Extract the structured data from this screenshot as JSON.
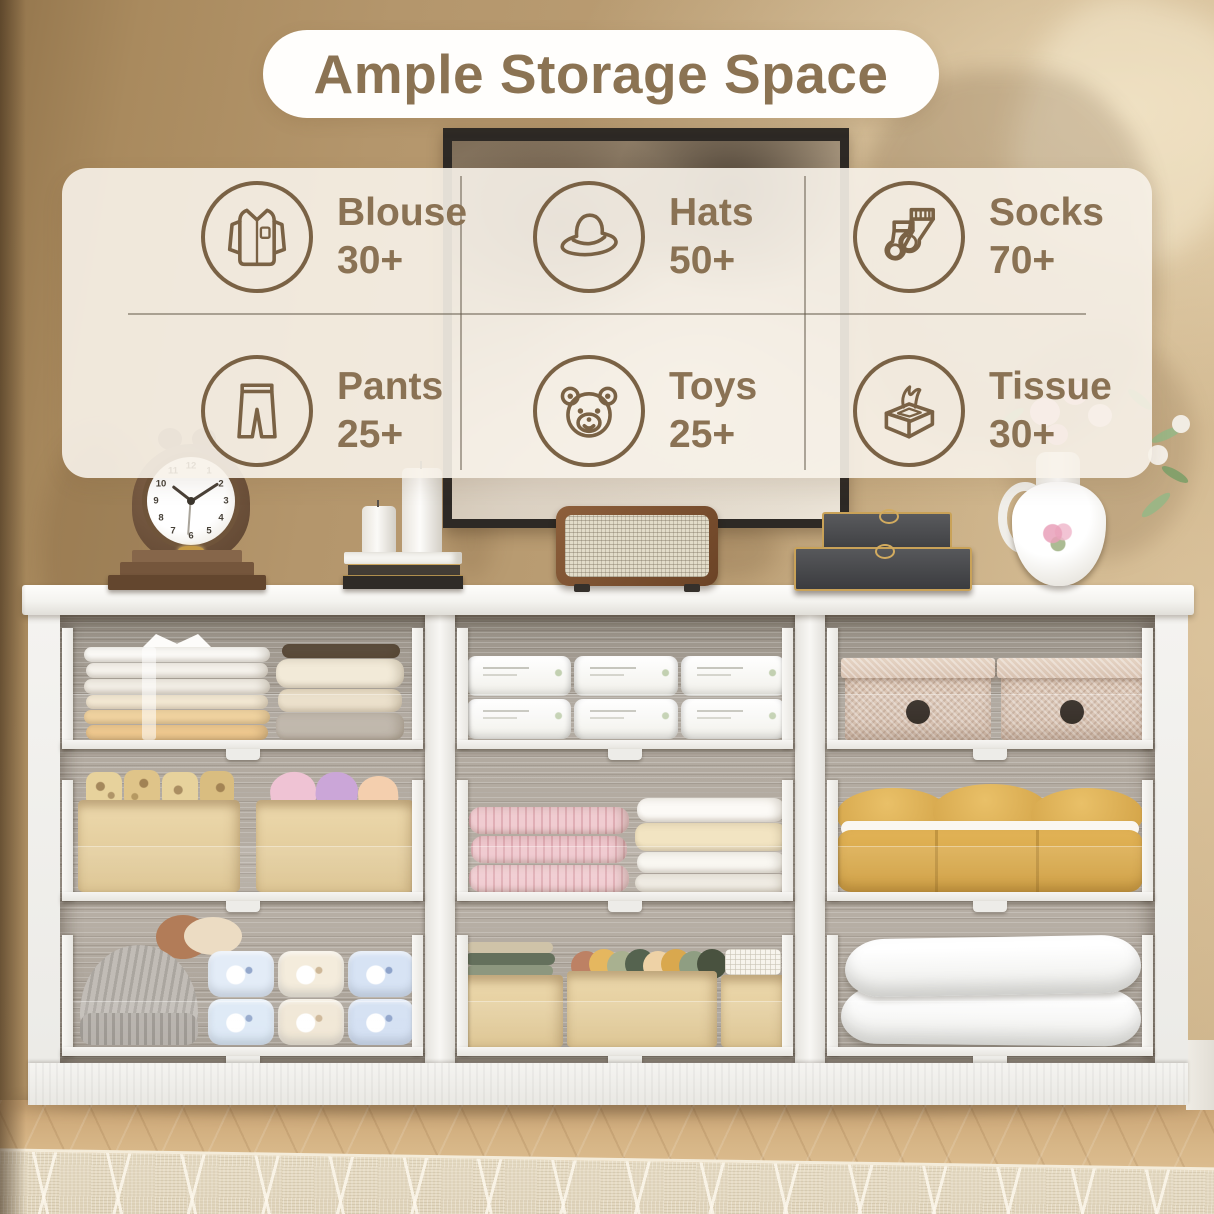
{
  "title": "Ample Storage Space",
  "theme": {
    "accent_text": "#8b7353",
    "icon_stroke": "#7a6245",
    "panel_bg": "rgba(247,242,233,0.9)",
    "wall": "#bb9e74",
    "divider": "#625848"
  },
  "storage_items": [
    {
      "label": "Blouse",
      "count": "30+",
      "icon": "blouse-icon"
    },
    {
      "label": "Hats",
      "count": "50+",
      "icon": "hat-icon"
    },
    {
      "label": "Socks",
      "count": "70+",
      "icon": "socks-icon"
    },
    {
      "label": "Pants",
      "count": "25+",
      "icon": "pants-icon"
    },
    {
      "label": "Toys",
      "count": "25+",
      "icon": "teddy-bear-icon"
    },
    {
      "label": "Tissue",
      "count": "30+",
      "icon": "tissue-icon"
    }
  ],
  "clock": {
    "numerals": [
      "12",
      "1",
      "2",
      "3",
      "4",
      "5",
      "6",
      "7",
      "8",
      "9",
      "10",
      "11"
    ]
  },
  "scene_objects": {
    "wall_art": "abstract framed painting",
    "clock": "vintage twin-bell alarm clock on wooden base",
    "candles": "two white pillar candles on stacked books",
    "speaker": "rattan wicker speaker",
    "boxes": "two stacked dark keepsake boxes with gold trim",
    "vase": "white ceramic pitcher with pink roses and greenery",
    "furniture": "white nine-cubby sideboard with pull-out shelves",
    "floor": "light herringbone wood floor",
    "rug": "beige diamond-pattern rug"
  },
  "cubby_contents": [
    "folded shirts and sweaters",
    "cotton tissue packs",
    "woven storage boxes",
    "cloth bins with patterned rolls",
    "pink towels and white sheets",
    "yellow folded comforter",
    "knit beanie and rolled towels",
    "boxes of rolled socks",
    "two white pillows"
  ]
}
